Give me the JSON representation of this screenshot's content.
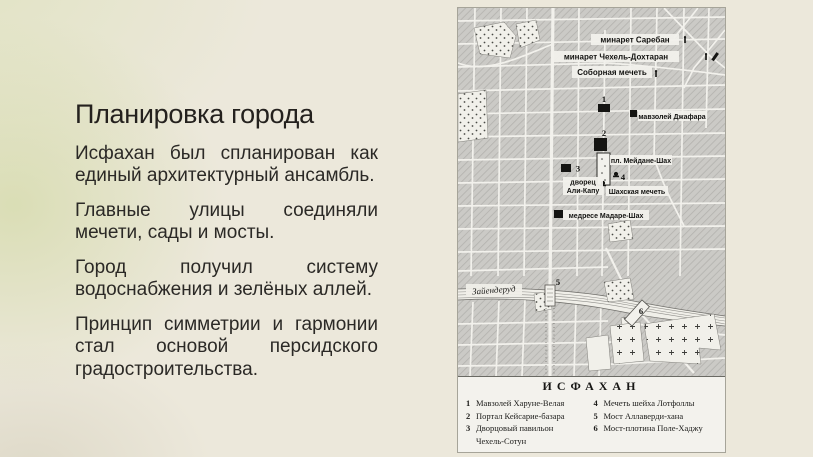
{
  "slide": {
    "title": "Планировка города",
    "paragraphs": [
      "Исфахан был спланирован как единый архитектурный ансамбль.",
      "Главные улицы соединяли мечети, сады и мосты.",
      "Город получил систему водоснабжения и зелёных аллей.",
      "Принцип симметрии и гармонии стал основой персидского градостроительства."
    ]
  },
  "map": {
    "labels": {
      "minaret_sareban": "минарет Саребан",
      "minaret_chehel": "минарет Чехель-Дохтаран",
      "cathedral_mosque": "Соборная мечеть",
      "mausoleum_jafar": "мавзолей Джафара",
      "meydan_shah": "пл. Мейдане-Шах",
      "palace_line1": "дворец",
      "palace_line2": "Али-Капу",
      "shah_mosque": "Шахская мечеть",
      "madrese": "медресе Мадаре-Шах",
      "river": "Зайендеруд"
    },
    "markers": {
      "m1": "1",
      "m2": "2",
      "m3": "3",
      "m4": "4",
      "m5": "5",
      "m6": "6"
    },
    "legend": {
      "title": "ИСФАХАН",
      "left": [
        {
          "num": "1",
          "line1": "Мавзолей Харуне-Велая"
        },
        {
          "num": "2",
          "line1": "Портал Кейсарие-базара"
        },
        {
          "num": "3",
          "line1": "Дворцовый павильон",
          "line2": "Чехель-Сотун"
        }
      ],
      "right": [
        {
          "num": "4",
          "line1": "Мечеть шейха Лотфоллы"
        },
        {
          "num": "5",
          "line1": "Мост Аллаверди-хана"
        },
        {
          "num": "6",
          "line1": "Мост-плотина Поле-Хаджу"
        }
      ]
    }
  },
  "colors": {
    "slide_background": "#ece8db",
    "accent_green": "#d6dda0",
    "body_text": "#2b2926",
    "map_paper": "#f2f1ec",
    "map_block_gray": "#cbcac6",
    "map_ink": "#141412"
  }
}
